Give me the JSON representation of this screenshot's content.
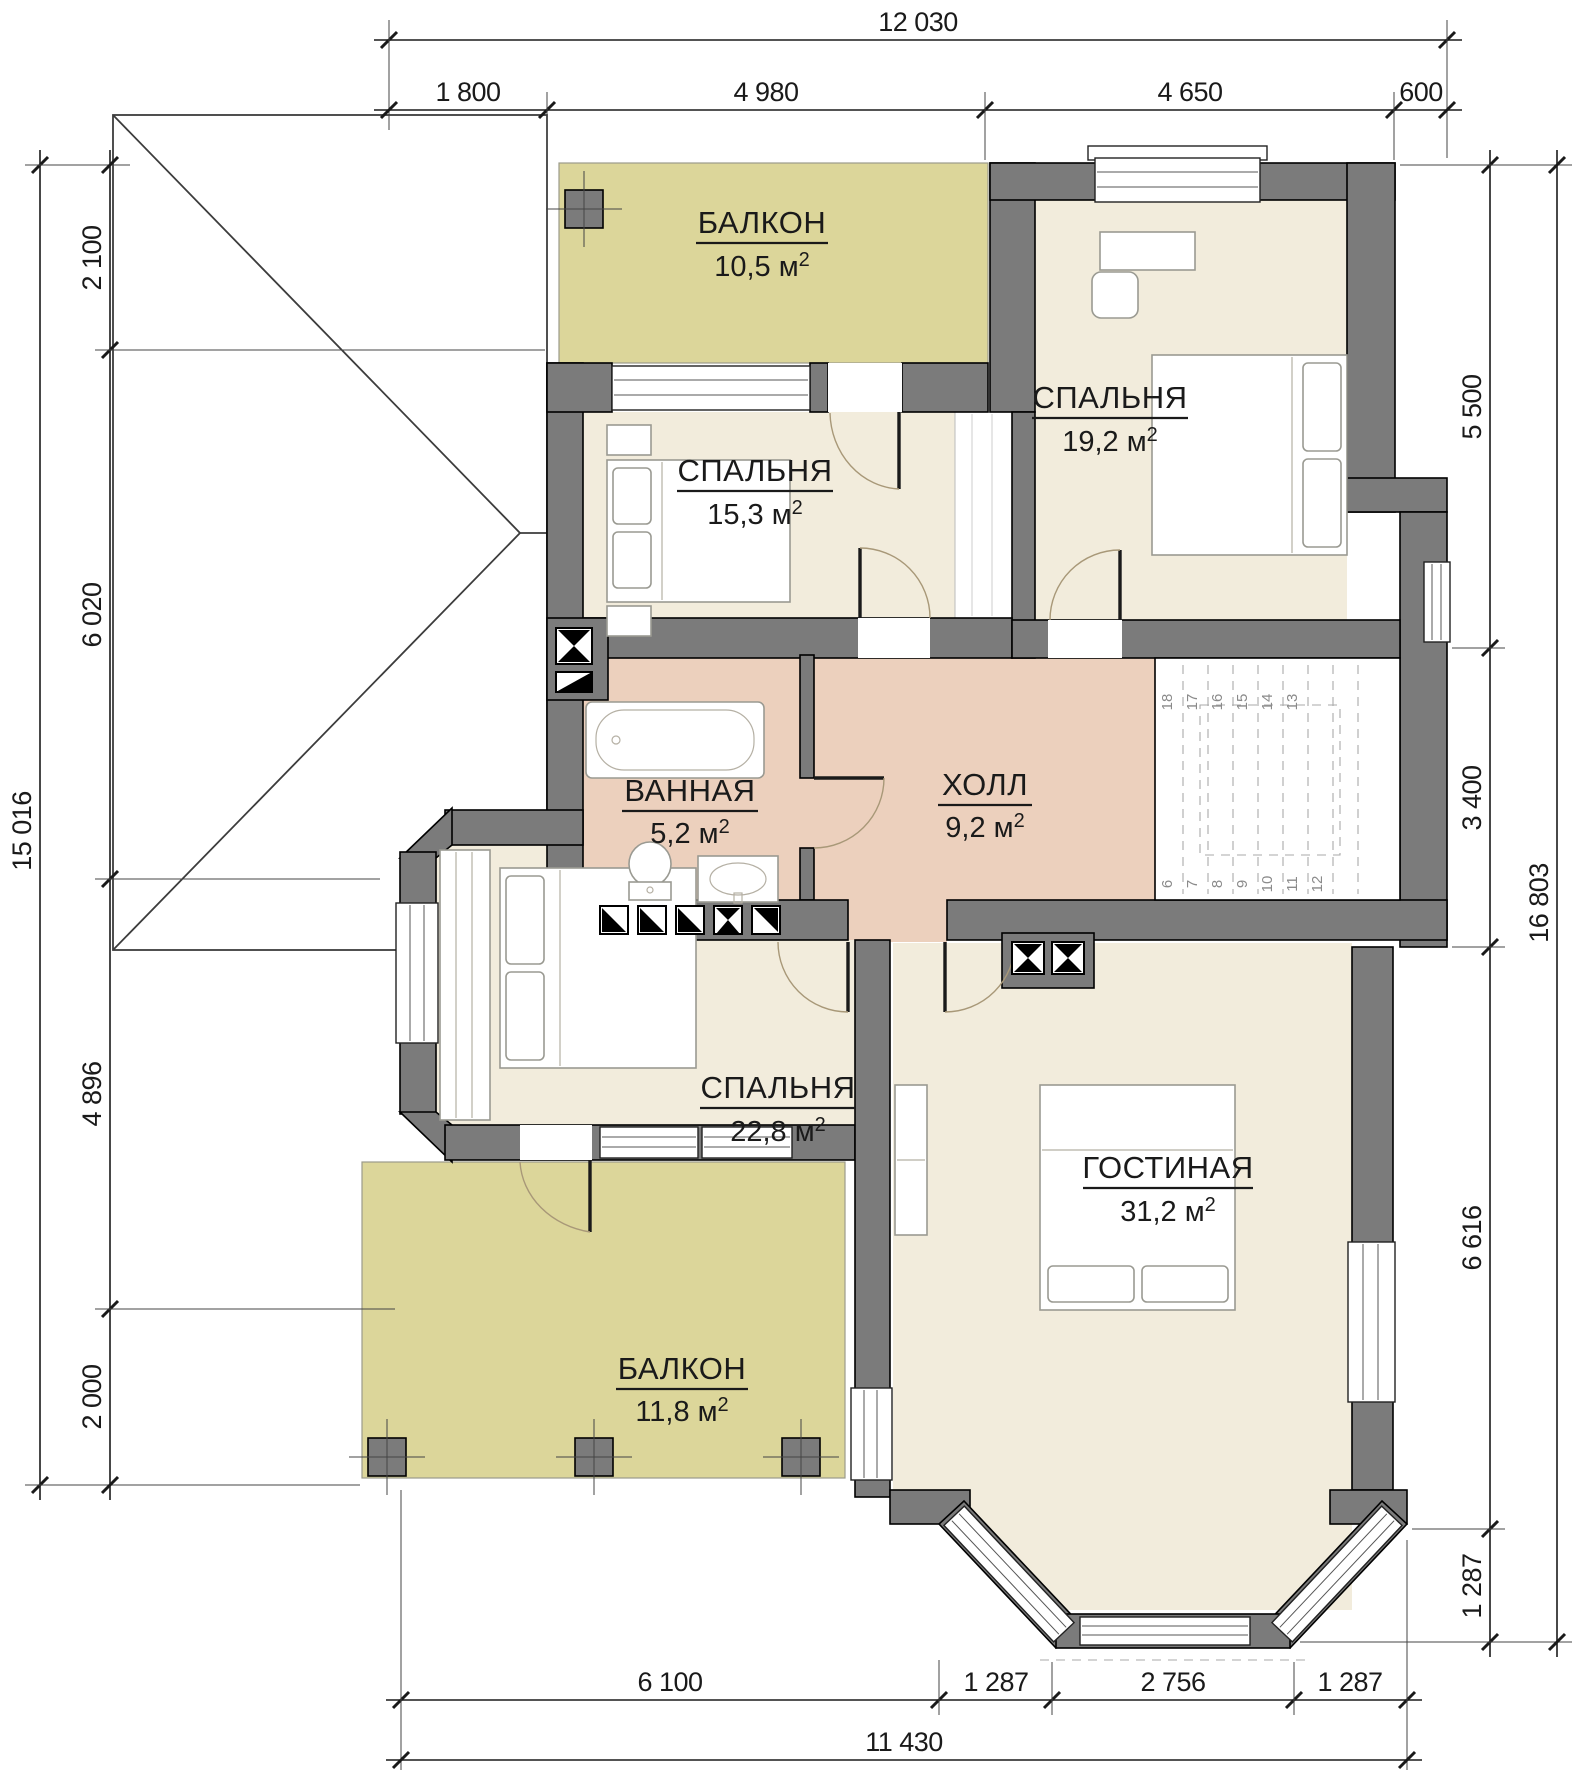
{
  "rooms": [
    {
      "id": "balcony-top",
      "name": "БАЛКОН",
      "area": "10,5"
    },
    {
      "id": "bedroom-19",
      "name": "СПАЛЬНЯ",
      "area": "19,2"
    },
    {
      "id": "bedroom-15",
      "name": "СПАЛЬНЯ",
      "area": "15,3"
    },
    {
      "id": "bathroom",
      "name": "ВАННАЯ",
      "area": "5,2"
    },
    {
      "id": "hall",
      "name": "ХОЛЛ",
      "area": "9,2"
    },
    {
      "id": "bedroom-22",
      "name": "СПАЛЬНЯ",
      "area": "22,8"
    },
    {
      "id": "living-room",
      "name": "ГОСТИНАЯ",
      "area": "31,2"
    },
    {
      "id": "balcony-bottom",
      "name": "БАЛКОН",
      "area": "11,8"
    }
  ],
  "units": {
    "base": "м",
    "sup": "2"
  },
  "dims": {
    "top": {
      "overall": "12 030",
      "segments": [
        "1 800",
        "4 980",
        "4 650",
        "600"
      ]
    },
    "left": {
      "overall": "15 016",
      "segments": [
        "2 100",
        "6 020",
        "4 896",
        "2 000"
      ]
    },
    "right": {
      "overall": "16 803",
      "segments": [
        "5 500",
        "3 400",
        "6 616",
        "1 287"
      ]
    },
    "bottom": {
      "overall": "11 430",
      "segments": [
        "6 100",
        "1 287",
        "2 756",
        "1 287"
      ]
    }
  },
  "stairs": {
    "top": [
      "18",
      "17",
      "16",
      "15",
      "14",
      "13"
    ],
    "bottom": [
      "6",
      "7",
      "8",
      "9",
      "10",
      "11",
      "12"
    ]
  },
  "colors": {
    "wall": "#7b7b7b",
    "room": "#f2ecdc",
    "wet": "#ecd0bd",
    "balcony": "#dcd69a",
    "stairwell": "#ffffff"
  }
}
